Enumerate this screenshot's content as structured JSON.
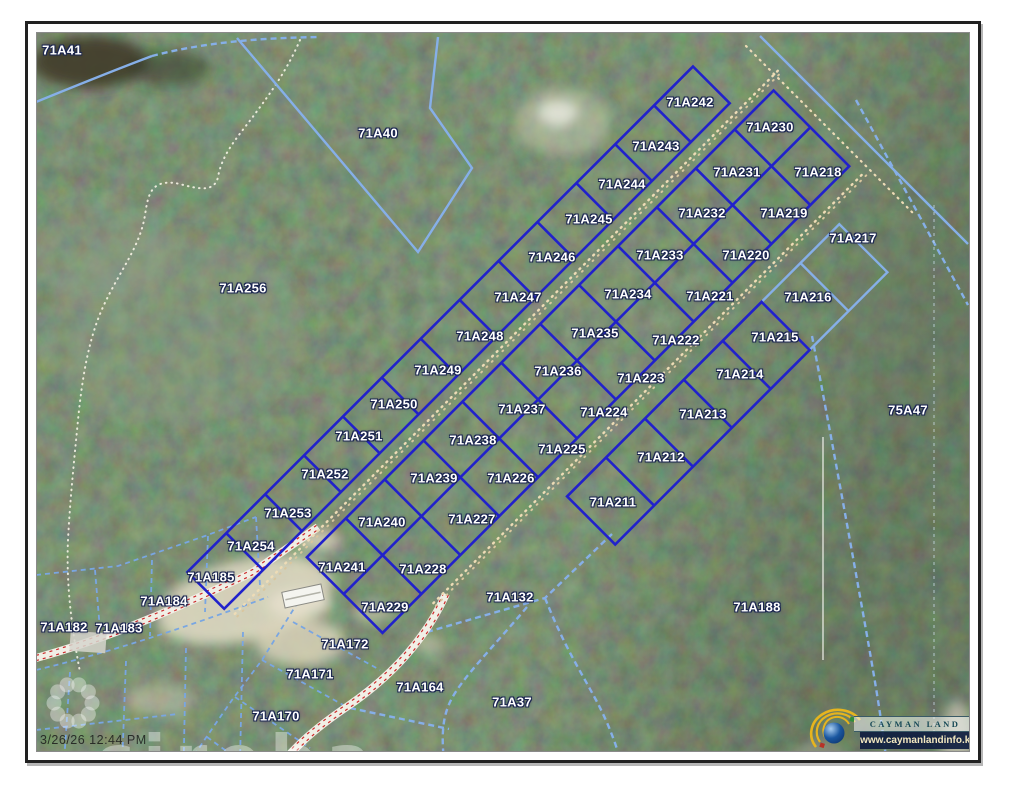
{
  "map": {
    "type": "cadastral-parcel-map",
    "timestamp": "3/26/26 12:44 PM",
    "watermark_brand": "cireba",
    "logo": {
      "title": "CAYMAN LAND INFO",
      "url": "www.caymanlandinfo.ky"
    },
    "colors": {
      "subdivision_parcel": "#2121cb",
      "registry_parcel": "#86afe8",
      "road_centerline_dash": "#cc2a2a",
      "dirt_track_dots": "#eedcb6",
      "label_text": "#ffffff",
      "label_halo": "#1b2550"
    },
    "labels": [
      {
        "id": "71A41",
        "x": 62,
        "y": 50,
        "kind": "registry"
      },
      {
        "id": "71A40",
        "x": 378,
        "y": 133,
        "kind": "registry"
      },
      {
        "id": "71A256",
        "x": 243,
        "y": 288,
        "kind": "registry"
      },
      {
        "id": "71A242",
        "x": 690,
        "y": 102,
        "kind": "subdivision"
      },
      {
        "id": "71A230",
        "x": 770,
        "y": 127,
        "kind": "subdivision"
      },
      {
        "id": "71A243",
        "x": 656,
        "y": 146,
        "kind": "subdivision"
      },
      {
        "id": "71A231",
        "x": 737,
        "y": 172,
        "kind": "subdivision"
      },
      {
        "id": "71A218",
        "x": 818,
        "y": 172,
        "kind": "subdivision"
      },
      {
        "id": "71A244",
        "x": 622,
        "y": 184,
        "kind": "subdivision"
      },
      {
        "id": "71A232",
        "x": 702,
        "y": 213,
        "kind": "subdivision"
      },
      {
        "id": "71A219",
        "x": 784,
        "y": 213,
        "kind": "subdivision"
      },
      {
        "id": "71A217",
        "x": 853,
        "y": 238,
        "kind": "registry"
      },
      {
        "id": "71A245",
        "x": 589,
        "y": 219,
        "kind": "subdivision"
      },
      {
        "id": "71A246",
        "x": 552,
        "y": 257,
        "kind": "subdivision"
      },
      {
        "id": "71A233",
        "x": 660,
        "y": 255,
        "kind": "subdivision"
      },
      {
        "id": "71A220",
        "x": 746,
        "y": 255,
        "kind": "subdivision"
      },
      {
        "id": "71A247",
        "x": 518,
        "y": 297,
        "kind": "subdivision"
      },
      {
        "id": "71A234",
        "x": 628,
        "y": 294,
        "kind": "subdivision"
      },
      {
        "id": "71A221",
        "x": 710,
        "y": 296,
        "kind": "subdivision"
      },
      {
        "id": "71A216",
        "x": 808,
        "y": 297,
        "kind": "registry"
      },
      {
        "id": "71A248",
        "x": 480,
        "y": 336,
        "kind": "subdivision"
      },
      {
        "id": "71A235",
        "x": 595,
        "y": 333,
        "kind": "subdivision"
      },
      {
        "id": "71A222",
        "x": 676,
        "y": 340,
        "kind": "subdivision"
      },
      {
        "id": "71A215",
        "x": 775,
        "y": 337,
        "kind": "subdivision"
      },
      {
        "id": "71A249",
        "x": 438,
        "y": 370,
        "kind": "subdivision"
      },
      {
        "id": "71A236",
        "x": 558,
        "y": 371,
        "kind": "subdivision"
      },
      {
        "id": "71A223",
        "x": 641,
        "y": 378,
        "kind": "subdivision"
      },
      {
        "id": "71A214",
        "x": 740,
        "y": 374,
        "kind": "subdivision"
      },
      {
        "id": "71A250",
        "x": 394,
        "y": 404,
        "kind": "subdivision"
      },
      {
        "id": "71A237",
        "x": 522,
        "y": 409,
        "kind": "subdivision"
      },
      {
        "id": "71A224",
        "x": 604,
        "y": 412,
        "kind": "subdivision"
      },
      {
        "id": "71A213",
        "x": 703,
        "y": 414,
        "kind": "subdivision"
      },
      {
        "id": "75A47",
        "x": 908,
        "y": 410,
        "kind": "registry"
      },
      {
        "id": "71A251",
        "x": 359,
        "y": 436,
        "kind": "subdivision"
      },
      {
        "id": "71A238",
        "x": 473,
        "y": 440,
        "kind": "subdivision"
      },
      {
        "id": "71A225",
        "x": 562,
        "y": 449,
        "kind": "subdivision"
      },
      {
        "id": "71A212",
        "x": 661,
        "y": 457,
        "kind": "subdivision"
      },
      {
        "id": "71A252",
        "x": 325,
        "y": 474,
        "kind": "subdivision"
      },
      {
        "id": "71A239",
        "x": 434,
        "y": 478,
        "kind": "subdivision"
      },
      {
        "id": "71A226",
        "x": 511,
        "y": 478,
        "kind": "subdivision"
      },
      {
        "id": "71A253",
        "x": 288,
        "y": 513,
        "kind": "subdivision"
      },
      {
        "id": "71A227",
        "x": 472,
        "y": 519,
        "kind": "subdivision"
      },
      {
        "id": "71A211",
        "x": 613,
        "y": 502,
        "kind": "subdivision"
      },
      {
        "id": "71A254",
        "x": 251,
        "y": 546,
        "kind": "subdivision"
      },
      {
        "id": "71A240",
        "x": 382,
        "y": 522,
        "kind": "subdivision"
      },
      {
        "id": "71A185",
        "x": 211,
        "y": 577,
        "kind": "registry"
      },
      {
        "id": "71A241",
        "x": 342,
        "y": 567,
        "kind": "subdivision"
      },
      {
        "id": "71A228",
        "x": 423,
        "y": 569,
        "kind": "subdivision"
      },
      {
        "id": "71A184",
        "x": 164,
        "y": 601,
        "kind": "registry"
      },
      {
        "id": "71A182",
        "x": 64,
        "y": 627,
        "kind": "registry"
      },
      {
        "id": "71A183",
        "x": 119,
        "y": 628,
        "kind": "registry"
      },
      {
        "id": "71A229",
        "x": 385,
        "y": 607,
        "kind": "subdivision"
      },
      {
        "id": "71A132",
        "x": 510,
        "y": 597,
        "kind": "registry"
      },
      {
        "id": "71A172",
        "x": 345,
        "y": 644,
        "kind": "registry"
      },
      {
        "id": "71A188",
        "x": 757,
        "y": 607,
        "kind": "registry"
      },
      {
        "id": "71A171",
        "x": 310,
        "y": 674,
        "kind": "registry"
      },
      {
        "id": "71A164",
        "x": 420,
        "y": 687,
        "kind": "registry"
      },
      {
        "id": "71A170",
        "x": 276,
        "y": 716,
        "kind": "registry"
      },
      {
        "id": "71A37",
        "x": 512,
        "y": 702,
        "kind": "registry"
      }
    ]
  }
}
